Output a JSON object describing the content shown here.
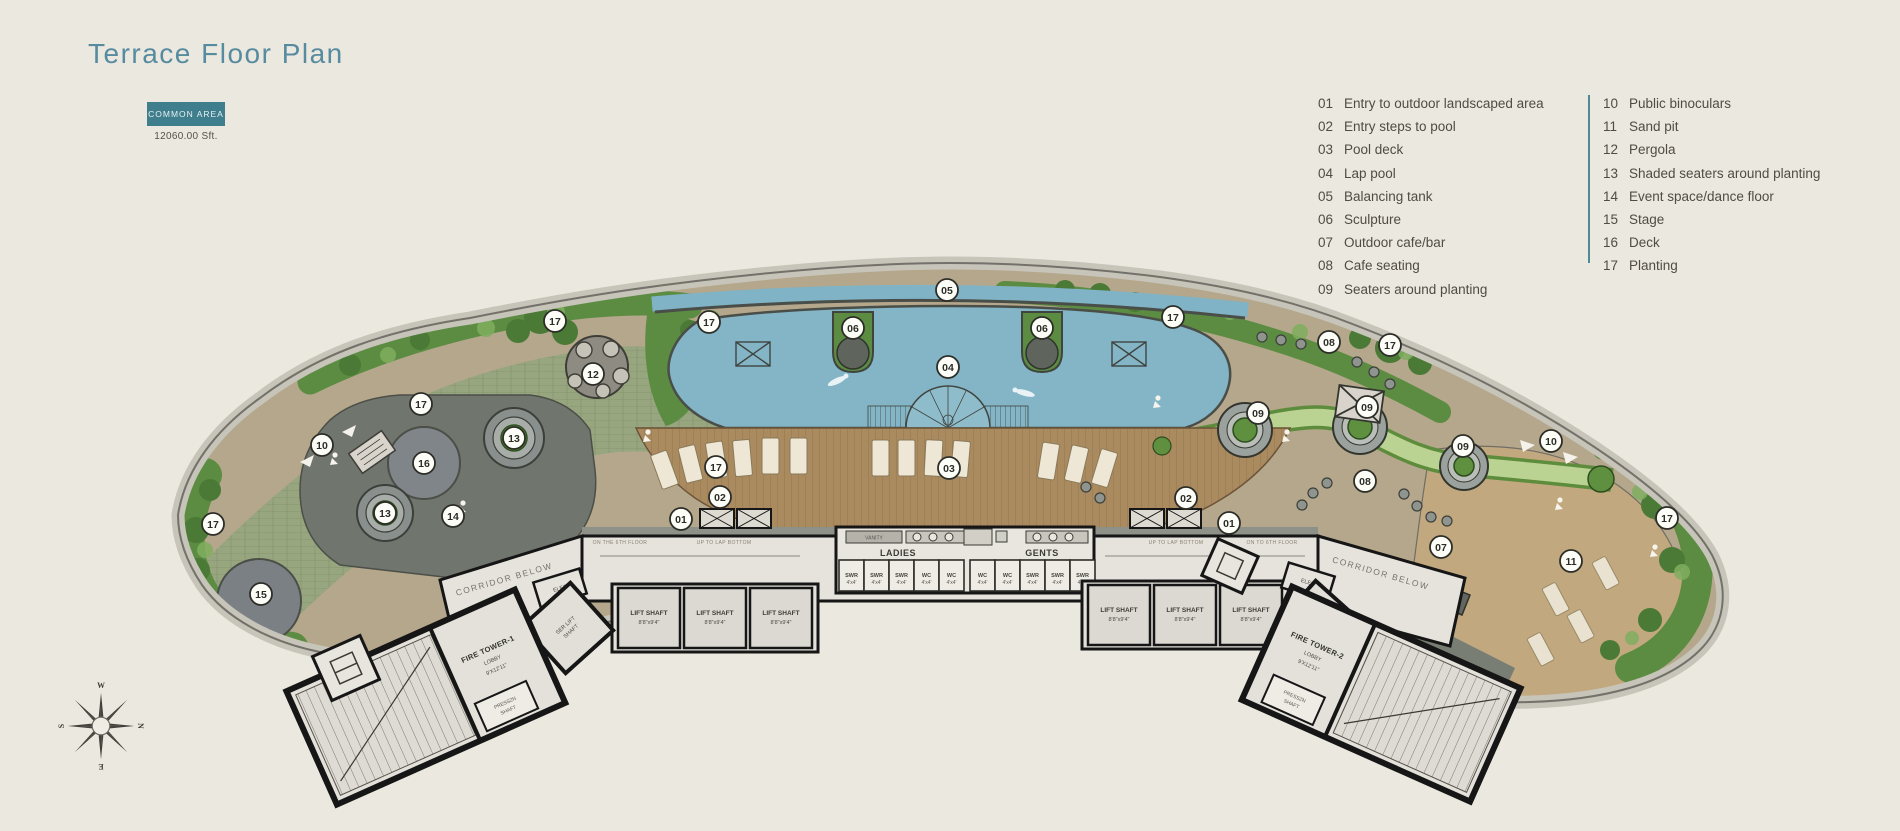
{
  "page": {
    "title": "Terrace Floor Plan",
    "badge": "COMMON AREA",
    "area": "12060.00 Sft."
  },
  "legend": {
    "columns": [
      [
        {
          "num": "01",
          "label": "Entry to outdoor landscaped area"
        },
        {
          "num": "02",
          "label": "Entry steps to pool"
        },
        {
          "num": "03",
          "label": "Pool deck"
        },
        {
          "num": "04",
          "label": "Lap pool"
        },
        {
          "num": "05",
          "label": "Balancing tank"
        },
        {
          "num": "06",
          "label": "Sculpture"
        },
        {
          "num": "07",
          "label": "Outdoor cafe/bar"
        },
        {
          "num": "08",
          "label": "Cafe seating"
        },
        {
          "num": "09",
          "label": "Seaters around planting"
        }
      ],
      [
        {
          "num": "10",
          "label": "Public binoculars"
        },
        {
          "num": "11",
          "label": "Sand pit"
        },
        {
          "num": "12",
          "label": "Pergola"
        },
        {
          "num": "13",
          "label": "Shaded seaters around planting"
        },
        {
          "num": "14",
          "label": "Event space/dance floor"
        },
        {
          "num": "15",
          "label": "Stage"
        },
        {
          "num": "16",
          "label": "Deck"
        },
        {
          "num": "17",
          "label": "Planting"
        }
      ]
    ]
  },
  "plan": {
    "markers": [
      {
        "n": "17",
        "x": 555,
        "y": 321
      },
      {
        "n": "17",
        "x": 709,
        "y": 322
      },
      {
        "n": "05",
        "x": 947,
        "y": 290
      },
      {
        "n": "06",
        "x": 853,
        "y": 328
      },
      {
        "n": "06",
        "x": 1042,
        "y": 328
      },
      {
        "n": "04",
        "x": 948,
        "y": 367
      },
      {
        "n": "17",
        "x": 1173,
        "y": 317
      },
      {
        "n": "12",
        "x": 593,
        "y": 374
      },
      {
        "n": "17",
        "x": 421,
        "y": 404
      },
      {
        "n": "10",
        "x": 322,
        "y": 445
      },
      {
        "n": "16",
        "x": 424,
        "y": 463
      },
      {
        "n": "13",
        "x": 514,
        "y": 438
      },
      {
        "n": "13",
        "x": 385,
        "y": 513
      },
      {
        "n": "14",
        "x": 453,
        "y": 516
      },
      {
        "n": "17",
        "x": 213,
        "y": 524
      },
      {
        "n": "15",
        "x": 261,
        "y": 594
      },
      {
        "n": "03",
        "x": 949,
        "y": 468
      },
      {
        "n": "17",
        "x": 716,
        "y": 467
      },
      {
        "n": "02",
        "x": 720,
        "y": 497
      },
      {
        "n": "01",
        "x": 681,
        "y": 519
      },
      {
        "n": "02",
        "x": 1186,
        "y": 498
      },
      {
        "n": "01",
        "x": 1229,
        "y": 523
      },
      {
        "n": "08",
        "x": 1329,
        "y": 342
      },
      {
        "n": "17",
        "x": 1390,
        "y": 345
      },
      {
        "n": "09",
        "x": 1258,
        "y": 413
      },
      {
        "n": "09",
        "x": 1367,
        "y": 407
      },
      {
        "n": "09",
        "x": 1463,
        "y": 446
      },
      {
        "n": "10",
        "x": 1551,
        "y": 441
      },
      {
        "n": "08",
        "x": 1365,
        "y": 481
      },
      {
        "n": "07",
        "x": 1441,
        "y": 547
      },
      {
        "n": "11",
        "x": 1571,
        "y": 561
      },
      {
        "n": "17",
        "x": 1667,
        "y": 518
      }
    ],
    "toilets": {
      "ladies": "LADIES",
      "gents": "GENTS",
      "vanity": "VANITY",
      "stalls": [
        "SWR",
        "SWR",
        "SWR",
        "WC",
        "WC",
        "WC",
        "WC",
        "SWR",
        "SWR",
        "SWR"
      ],
      "stall_size": "4'x4'"
    },
    "labels": {
      "corridor_below": "CORRIDOR BELOW",
      "lift_shaft": "LIFT SHAFT",
      "lift_shaft_size": "8'8\"x9'4\"",
      "fire_tower_1": "FIRE TOWER-1",
      "fire_tower_2": "FIRE TOWER-2",
      "lobby": "LOBBY",
      "lobby_size": "9'X12'11\"",
      "presszn": "PRESSZN",
      "shaft": "SHAFT",
      "ser_lift": "SER LIFT",
      "elec": "ELEC",
      "on_the_6th_floor": "ON THE 6TH FLOOR",
      "up_to_lap_bottom": "UP TO LAP BOTTOM",
      "on_to_6th_floor": "ON TO 6TH FLOOR"
    },
    "compass": {
      "n": "N",
      "e": "E",
      "s": "S",
      "w": "W"
    }
  },
  "colors": {
    "background": "#ebe8df",
    "title_teal": "#578ba0",
    "badge_teal": "#3e7e8d",
    "legend_divider": "#4e8a96",
    "pool_blue": "#83b5c6",
    "planting_green": "#5c8c42",
    "deck_wood": "#aa8b60",
    "terrain_tan": "#b5a78b",
    "event_grey": "#70756d"
  }
}
